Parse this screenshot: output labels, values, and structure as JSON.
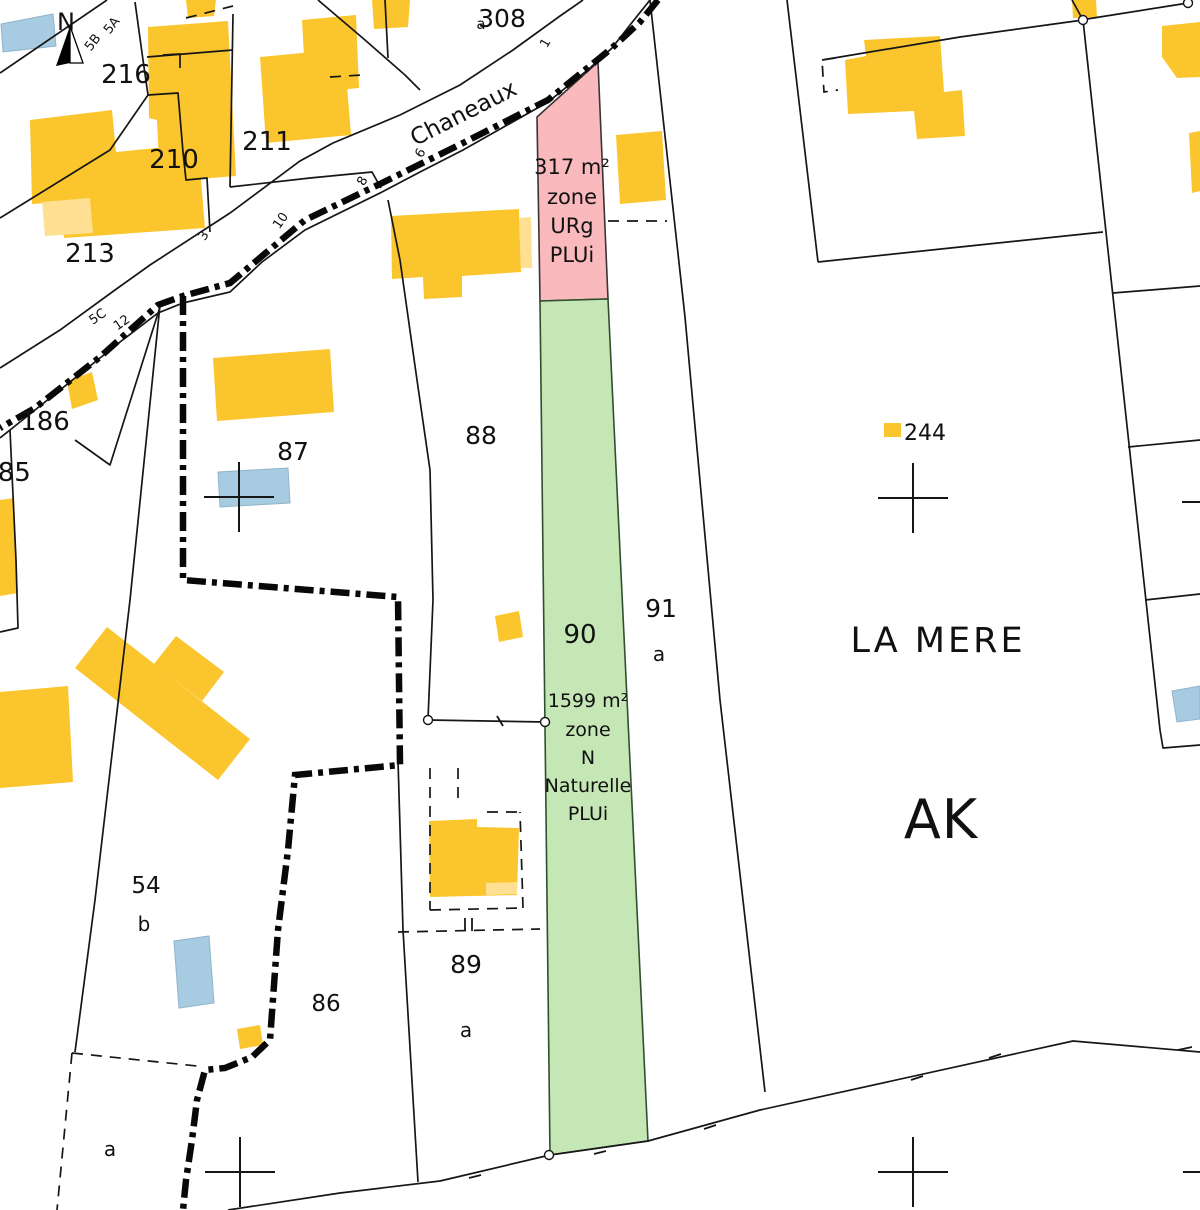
{
  "colors": {
    "building_yellow": "#fbc52d",
    "building_light": "#ffe093",
    "building_blue": "#a7cbe0",
    "line": "#161616",
    "boundary": "#080808",
    "zone_urg_fill": "#f9b9bd",
    "zone_urg_stroke": "#3a3434",
    "zone_urg_text": "#e01f2f",
    "zone_n_fill": "#c5e6b5",
    "zone_n_stroke": "#2f4f2f",
    "zone_n_text": "#1e8a1e"
  },
  "north_arrow": {
    "letter": "N",
    "x": 66,
    "y": 30,
    "size": 24,
    "dark": "70,26 70,63 56,66",
    "light": "70,26 70,63 83,63"
  },
  "zones": [
    {
      "id": "urg",
      "points": "598,62 608,299 540,301 537,117",
      "fill": "#f9b9bd",
      "stroke": "#3a3434",
      "text_color": "#e01f2f",
      "label_x": 572,
      "label_size": 21,
      "label_ys": [
        174,
        204,
        233,
        262
      ],
      "lines": [
        "317 m²",
        "zone",
        "URg",
        "PLUi"
      ]
    },
    {
      "id": "n",
      "points": "540,301 608,299 648,1141 550,1155",
      "fill": "#c5e6b5",
      "stroke": "#2f4f2f",
      "text_color": "#1e8a1e",
      "label_x": 588,
      "label_size": 19,
      "label_ys": [
        707,
        736,
        764,
        792,
        820
      ],
      "lines": [
        "1599 m²",
        "zone",
        "N",
        "Naturelle",
        "PLUi"
      ]
    }
  ],
  "parcel_labels": [
    {
      "t": "216",
      "x": 126,
      "y": 83,
      "s": 26
    },
    {
      "t": "211",
      "x": 267,
      "y": 150,
      "s": 26
    },
    {
      "t": "210",
      "x": 174,
      "y": 168,
      "s": 26
    },
    {
      "t": "213",
      "x": 90,
      "y": 262,
      "s": 26
    },
    {
      "t": "308",
      "x": 502,
      "y": 27,
      "s": 25
    },
    {
      "t": "186",
      "x": 45,
      "y": 430,
      "s": 26
    },
    {
      "t": "185",
      "x": 6,
      "y": 481,
      "s": 26
    },
    {
      "t": "87",
      "x": 293,
      "y": 460,
      "s": 25
    },
    {
      "t": "88",
      "x": 481,
      "y": 444,
      "s": 25
    },
    {
      "t": "90",
      "x": 580,
      "y": 643,
      "s": 26
    },
    {
      "t": "91",
      "x": 661,
      "y": 617,
      "s": 25
    },
    {
      "t": "54",
      "x": 146,
      "y": 893,
      "s": 23
    },
    {
      "t": "86",
      "x": 326,
      "y": 1011,
      "s": 23
    },
    {
      "t": "89",
      "x": 466,
      "y": 973,
      "s": 25
    }
  ],
  "sub_labels": [
    {
      "t": "a",
      "x": 481,
      "y": 29,
      "s": 15
    },
    {
      "t": "a",
      "x": 659,
      "y": 661,
      "s": 20
    },
    {
      "t": "b",
      "x": 144,
      "y": 931,
      "s": 20
    },
    {
      "t": "a",
      "x": 466,
      "y": 1037,
      "s": 20
    },
    {
      "t": "a",
      "x": 110,
      "y": 1156,
      "s": 20
    }
  ],
  "place_labels": [
    {
      "t": "LA MERE",
      "x": 938,
      "y": 652,
      "s": 35,
      "ls": 3,
      "name": "locality-name-la-mere"
    },
    {
      "t": "AK",
      "x": 941,
      "y": 838,
      "s": 54,
      "ls": 1,
      "name": "section-label-ak"
    }
  ],
  "street": {
    "t": "Chaneaux",
    "x": 467,
    "y": 120,
    "s": 23,
    "r": -27
  },
  "addresses": [
    {
      "t": "1",
      "x": 549,
      "y": 45,
      "r": -60
    },
    {
      "t": "6",
      "x": 424,
      "y": 155,
      "r": -60
    },
    {
      "t": "8",
      "x": 366,
      "y": 183,
      "r": -60
    },
    {
      "t": "10",
      "x": 284,
      "y": 223,
      "r": -55
    },
    {
      "t": "3",
      "x": 207,
      "y": 238,
      "r": -55
    },
    {
      "t": "5C",
      "x": 100,
      "y": 320,
      "r": -35
    },
    {
      "t": "12",
      "x": 124,
      "y": 326,
      "r": -35
    },
    {
      "t": "5B",
      "x": 96,
      "y": 45,
      "r": -52
    },
    {
      "t": "5A",
      "x": 115,
      "y": 28,
      "r": -52
    }
  ],
  "legend": {
    "t": "244",
    "x": 904,
    "y": 440,
    "s": 22,
    "marker": "884,423 901,423 901,437 884,437"
  },
  "geometry": {
    "roads": [
      "583,0 560,16 513,50 460,85 400,115 333,143 300,161 230,213 150,265 115,290 60,330 0,368",
      "650,0 630,25 612,48 590,68 548,102 463,150 420,172 382,192 305,230 262,262 230,292 183,303 158,313 120,342 60,390 20,422 0,438"
    ],
    "parcel_lines": [
      "107,0 0,73",
      "135,2 143,60 148,95",
      "148,95 110,150 0,218",
      "148,95 178,93 183,152 186,180 207,178 210,232",
      "147,57 233,50",
      "233,14 230,187",
      "230,187 310,178 372,172 381,188",
      "163,55 180,54 180,68",
      "318,0 365,40 405,75 420,90",
      "787,0 818,262",
      "818,262 960,247 1103,232",
      "1083,20 1160,730",
      "1113,293 1200,286",
      "1128,447 1200,440",
      "1145,600 1200,594",
      "1160,730 1163,748 1200,745",
      "1188,3 1087,19",
      "1083,20 960,37 822,60",
      "1072,0 1083,20",
      "650,0 685,317 720,700 765,1092",
      "388,200 400,260 417,380 430,470 433,600 428,719",
      "428,720 545,722",
      "398,760 403,930 418,1182",
      "160,305 130,600 95,900 75,1052",
      "75,440 110,465 160,307",
      "10,430 16,560 18,628 0,632",
      "385,0 388,58",
      "228,1210 340,1193 440,1181 550,1155 648,1141 760,1110 1073,1041 1200,1052"
    ],
    "dashed_lines": [
      "608,221 667,221",
      "330,77 362,75",
      "186,18 233,6",
      "835,58 822,60 824,92 838,90",
      "398,932 540,929",
      "430,768 430,910",
      "458,768 458,800",
      "430,910 523,908",
      "523,908 520,812",
      "487,812 520,812",
      "72,1053 197,1066",
      "72,1053 57,1210"
    ],
    "boundary": [
      "658,0 640,22 612,48 548,100 463,143 382,183 305,220 230,283 183,296 158,305 100,357 35,408 0,428",
      "183,296 183,580 398,597 400,765 295,775 288,850 278,930 270,1040 252,1057 225,1068 205,1070 197,1100 192,1140 186,1180 183,1210"
    ],
    "yellow": [
      "186,0 216,0 214,16 188,18",
      "148,27 228,21 236,176 160,182 157,120 149,118",
      "260,57 344,49 351,135 266,143",
      "302,20 356,15 359,88 306,93",
      "372,0 410,0 408,27 374,29",
      "30,120 112,110 116,152 198,144 205,228 64,238 60,202 32,204",
      "67,381 92,372 98,400 72,409",
      "0,500 14,498 18,593 0,596",
      "0,692 68,686 73,782 0,788",
      "213,358 330,349 334,412 217,421",
      "391,216 519,209 521,272 462,276 462,297 424,299 423,277 392,279",
      "495,616 519,611 523,637 499,642",
      "429,821 477,819 477,827 519,828 517,895 430,897",
      "107,627 250,739 218,780 75,668",
      "176,636 224,672 202,701 154,664",
      "237,1029 260,1025 263,1045 240,1049",
      "845,60 866,56 864,40 940,36 944,92 962,90 965,136 917,139 914,111 848,114",
      "1072,0 1096,0 1097,17 1073,18",
      "1162,26 1200,22 1200,77 1177,78 1162,57",
      "1189,133 1200,131 1200,191 1192,193",
      "616,135 662,131 666,200 620,204"
    ],
    "pale": [
      "42,202 90,198 93,233 45,236",
      "519,218 531,217 532,268 521,268",
      "486,883 517,882 517,894 486,895"
    ],
    "blue": [
      "1,24 53,14 56,46 3,52",
      "218,472 288,468 290,503 220,507",
      "174,941 209,936 214,1003 179,1008",
      "1172,691 1200,686 1200,719 1177,722"
    ],
    "circles": [
      [
        1188,
        3
      ],
      [
        1083,
        20
      ],
      [
        428,
        720
      ],
      [
        545,
        722
      ],
      [
        549,
        1155
      ]
    ],
    "crosses": [
      [
        239,
        497
      ],
      [
        913,
        498
      ],
      [
        240,
        1172
      ],
      [
        913,
        1172
      ]
    ],
    "partial_crosses": [
      [
        1182,
        502,
        1200,
        502
      ],
      [
        1183,
        1172,
        1200,
        1172
      ]
    ],
    "ticks": [
      [
        497,
        716,
        503,
        726
      ],
      [
        465,
        918,
        465,
        931
      ],
      [
        472,
        918,
        472,
        931
      ],
      [
        469,
        1178,
        481,
        1175
      ],
      [
        594,
        1154,
        606,
        1151
      ],
      [
        704,
        1129,
        716,
        1125
      ],
      [
        911,
        1080,
        923,
        1076
      ],
      [
        989,
        1058,
        1001,
        1054
      ],
      [
        1178,
        1050,
        1192,
        1047
      ]
    ]
  }
}
